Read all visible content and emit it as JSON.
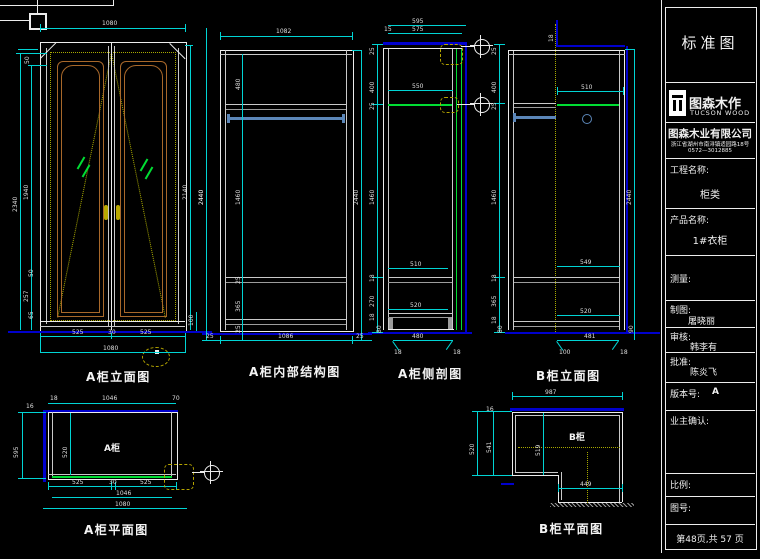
{
  "title_block": {
    "sheet_title": "标准图",
    "brand_name": "图森木作",
    "brand_sub": "TUCSON WOOD",
    "company": "图森木业有限公司",
    "address1": "浙江省湖州市南浔镇适园路18号",
    "address2": "0572—3012885",
    "project_label": "工程名称:",
    "project_value": "柜类",
    "product_label": "产品名称:",
    "product_value": "1#衣柜",
    "measure_label": "测量:",
    "draft_label": "制图:",
    "draft_value": "屠晓丽",
    "review_label": "审核:",
    "review_value": "韩李有",
    "approve_label": "批准:",
    "approve_value": "陈炎飞",
    "version_label": "版本号:",
    "version_value": "A",
    "owner_label": "业主确认:",
    "scale_label": "比例:",
    "drawing_no_label": "图号:",
    "page_info": "第48页,共 57 页"
  },
  "drawings": {
    "elevation_a": {
      "label": "A柜立面图",
      "dims": {
        "top": "1080",
        "l_2340": "2340",
        "l_1940": "1940",
        "l_50": "50",
        "lb_50": "50",
        "lb_257": "257",
        "lb_65": "65",
        "r_2140": "2140",
        "r_2440": "2440",
        "r_100": "100",
        "b_525l": "525",
        "b_30": "30",
        "b_525r": "525",
        "b_1080": "1080"
      }
    },
    "structure_a": {
      "label": "A柜内部结构图",
      "dims": {
        "top": "1082",
        "left": "2440",
        "right": "2440",
        "c_480": "480",
        "c_1460": "1460",
        "c_25a": "25",
        "c_365": "365",
        "c_25b": "25",
        "b_25l": "25",
        "b_1086": "1086",
        "b_25r": "25"
      }
    },
    "section_a": {
      "label": "A柜侧剖图",
      "dims": {
        "top_595": "595",
        "top_575": "575",
        "top_15": "15",
        "l_25a": "25",
        "l_400": "400",
        "l_25b": "25",
        "l_1460": "1460",
        "l_18a": "18",
        "l_270": "270",
        "l_18b": "18",
        "l_80": "80",
        "m_550": "550",
        "m_510": "510",
        "m_520": "520",
        "b_480": "480",
        "b_18l": "18",
        "b_18r": "18"
      }
    },
    "elevation_b": {
      "label": "B柜立面图",
      "dims": {
        "t_18": "18",
        "m_510": "510",
        "l_25a": "25",
        "l_400": "400",
        "l_25b": "25",
        "l_1460": "1460",
        "l_18a": "18",
        "l_365": "365",
        "l_18b": "18",
        "l_80": "80",
        "r_2440": "2440",
        "r_90": "90",
        "m_549": "549",
        "m_520": "520",
        "b_481": "481",
        "b_100": "100",
        "b_18": "18"
      }
    },
    "plan_a": {
      "label": "A柜平面图",
      "room": "A柜",
      "dims": {
        "t_18": "18",
        "t_1046": "1046",
        "t_70": "70",
        "l_16": "16",
        "l_595": "595",
        "i_520": "520",
        "b_525l": "525",
        "b_30": "30",
        "b_525r": "525",
        "b_1046": "1046",
        "b_1080": "1080"
      }
    },
    "plan_b": {
      "label": "B柜平面图",
      "room": "B柜",
      "dims": {
        "top": "987",
        "l_16": "16",
        "l_520": "520",
        "l_541": "541",
        "i_519": "519",
        "b_449": "449"
      }
    }
  }
}
